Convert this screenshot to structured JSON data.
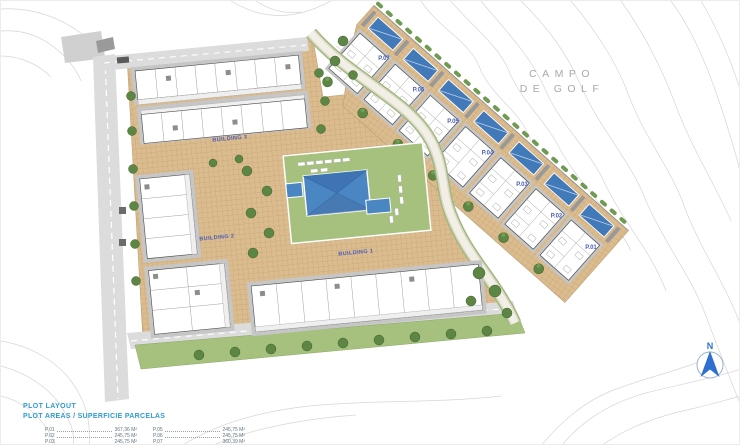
{
  "plan": {
    "golf_label_line1": "CAMPO",
    "golf_label_line2": "DE GOLF",
    "north_label": "N",
    "buildings": [
      {
        "label": "BUILDING 3"
      },
      {
        "label": "BUILDING 2"
      },
      {
        "label": "BUILDING 1"
      }
    ],
    "plots": [
      {
        "label": "P.07"
      },
      {
        "label": "P.06"
      },
      {
        "label": "P.05"
      },
      {
        "label": "P.04"
      },
      {
        "label": "P.03"
      },
      {
        "label": "P.02"
      },
      {
        "label": "P.01"
      }
    ]
  },
  "legend": {
    "title": "PLOT LAYOUT",
    "subtitle": "PLOT AREAS / SUPERFICIE PARCELAS",
    "columns": [
      {
        "rows": [
          {
            "plot": "P.01",
            "area": "367,36 M²"
          },
          {
            "plot": "P.02",
            "area": "245,75 M²"
          },
          {
            "plot": "P.03",
            "area": "245,75 M²"
          }
        ]
      },
      {
        "rows": [
          {
            "plot": "P.05",
            "area": "245,75 M²"
          },
          {
            "plot": "P.06",
            "area": "245,75 M²"
          },
          {
            "plot": "P.07",
            "area": "360,39 M²"
          }
        ]
      }
    ]
  },
  "colors": {
    "paving_tan": "#dbbc8f",
    "lawn_green": "#a6c17e",
    "pool_blue": "#4a86c2",
    "townhouse_pool_blue": "#4179b9",
    "roof_gray": "#c6c6c6",
    "road_gray": "#dcdcdc",
    "label_blue": "#4a5db8",
    "legend_blue": "#2f9bd0",
    "tree_green": "#5d8544",
    "golf_text_gray": "#a9a9a9",
    "north_blue": "#2e6fd0",
    "contour_gray": "#d6d6d6"
  }
}
